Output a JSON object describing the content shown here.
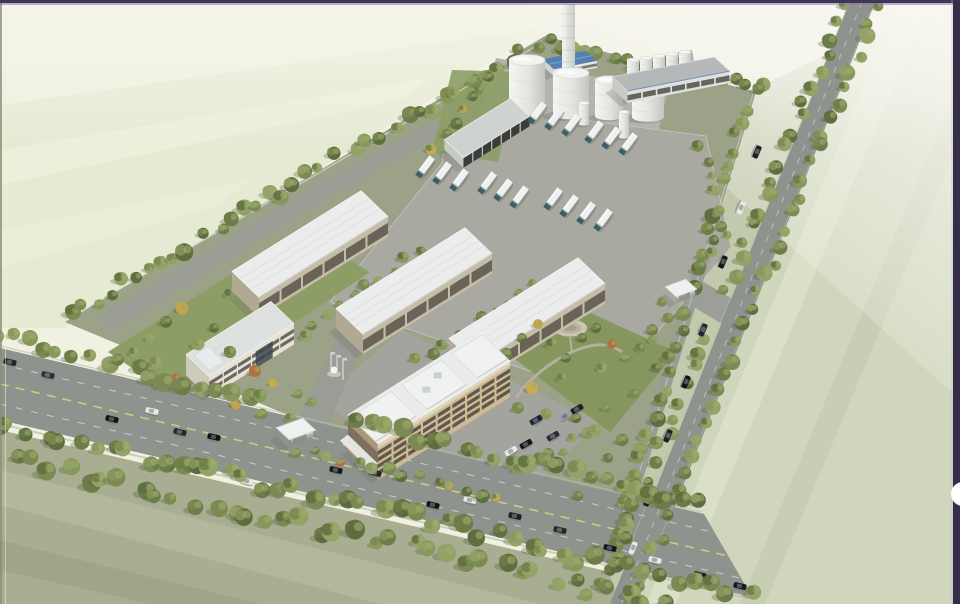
{
  "meta": {
    "subject": "aerial-rendering-industrial-campus",
    "canvas": {
      "w": 960,
      "h": 604
    }
  },
  "ui": {
    "next_button_color": "#ffffff"
  },
  "palette": {
    "base": "#f0f1e1",
    "sky_top": "#f5f4ea",
    "haze": "#f8f7f1",
    "field_nw": "#e6ead3",
    "field_nw_stripe": "#eef1dc",
    "field_sw": "#a9ae92",
    "field_sw_stripe1": "#b5ba9d",
    "field_sw_stripe2": "#9da387",
    "field_e": "#cfd6bc",
    "field_e_stripe1": "#dae0c8",
    "field_e_stripe2": "#c5ccb1",
    "field_band": "#c2c9ad",
    "campus": "#9ba287",
    "pavement": "#a9a9a1",
    "pavement2": "#a3a49d",
    "drive": "#9a9d96",
    "tank_pad": "#b3b4ad",
    "platform": "#b0b3ac",
    "road": "#8f938e",
    "road_edge": "#bcbfb3",
    "fence": "#d9dcd0",
    "lane_yellow": "#cfcf7d",
    "lane_white": "#dadcd5",
    "grass": "#8c9d66",
    "grass2": "#85965e",
    "path": "#b7b3a6",
    "plaza_outer": "#cdc6b2",
    "plaza_mid": "#b9b19b",
    "plaza_inner": "#a79e87",
    "tree_greens": [
      "#6d7c49",
      "#7b8a52",
      "#88985c",
      "#93a267",
      "#5f6e3f"
    ],
    "tree_accents": [
      "#c3a34c",
      "#b4703f",
      "#c9ab4d"
    ],
    "tree_shadow": "#4f5c38",
    "tree_highlight": "#9fae6d",
    "roof_white": "#ebedec",
    "roof_line": "#d6d8d9",
    "roof_edge_shade": "#c9cccb",
    "wall_tan": "#c6bda9",
    "wall_tan_dark": "#b2a995",
    "window_dark": "#514c44",
    "office_wall": "#cdbb97",
    "office_wall_dark": "#ab9878",
    "office_window": "#46403a",
    "office_parapet": "#e0d4b6",
    "small_office_wall": "#e6e3d6",
    "small_office_wall_dark": "#cfcaba",
    "small_office_roof": "#dde1e0",
    "glass_dark": "#3f4750",
    "long_roof": "#b4b8b8",
    "long_wall": "#e0e1db",
    "canopy_roof": "#ced2d1",
    "canopy_dark": "#3a3d38",
    "blue_roof": "#5580b2",
    "blue_ridge": "#7da0cc",
    "gate_roof": "#eff1f0",
    "tank_light": "#f5f6f3",
    "tank_mid": "#e2e4df",
    "tank_dark": "#c2c5bf",
    "tank_top": "#f2f3f0",
    "tank_seam": "#d2d4cf",
    "chimney_light": "#f2f3f0",
    "chimney_dark": "#c9ccc6",
    "chimney_band": "#b7bab4",
    "truck_body": "#eef1f0",
    "truck_cab": "#3d5f63",
    "truck_glass": "#9fb8ba",
    "shadow": "#6f746c",
    "frame_top": "#41345a",
    "frame_top2": "#8379a0",
    "frame_right": "#352d4a",
    "frame_left": "#8a8f7c",
    "frame_left_accent": "#eef0c4",
    "flag_pole": "#e8e8e4",
    "flag": "#cfd2d6",
    "fountain": "#f4f5f2",
    "fountain_base": "#c9c4b4"
  },
  "scene": {
    "tree_bands": [
      {
        "id": "nw-boundary",
        "x1": 70,
        "y1": 316,
        "x2": 538,
        "y2": 42,
        "n": 36,
        "r1": 5,
        "r2": 9,
        "j": 7,
        "palette": "green"
      },
      {
        "id": "north-tanks",
        "x1": 546,
        "y1": 40,
        "x2": 758,
        "y2": 88,
        "n": 17,
        "r1": 5,
        "r2": 8,
        "j": 6,
        "palette": "green"
      },
      {
        "id": "tanks-garden",
        "x1": 436,
        "y1": 148,
        "x2": 486,
        "y2": 78,
        "n": 7,
        "r1": 4,
        "r2": 6,
        "j": 5,
        "palette": "mixed"
      },
      {
        "id": "east-inner",
        "x1": 753,
        "y1": 94,
        "x2": 614,
        "y2": 548,
        "n": 32,
        "r1": 5,
        "r2": 8,
        "j": 6,
        "palette": "green",
        "gaps": [
          [
            0.42,
            0.48
          ]
        ]
      },
      {
        "id": "east-road-west",
        "x1": 845,
        "y1": 8,
        "x2": 602,
        "y2": 588,
        "n": 38,
        "r1": 5,
        "r2": 8,
        "j": 5,
        "palette": "green",
        "gaps": [
          [
            0.49,
            0.545
          ]
        ]
      },
      {
        "id": "east-road-east",
        "x1": 877,
        "y1": 4,
        "x2": 634,
        "y2": 600,
        "n": 38,
        "r1": 5,
        "r2": 8,
        "j": 5,
        "palette": "green"
      },
      {
        "id": "ne-parking-strip",
        "x1": 700,
        "y1": 142,
        "x2": 728,
        "y2": 238,
        "n": 7,
        "r1": 4,
        "r2": 6,
        "j": 5,
        "palette": "green"
      },
      {
        "id": "nw-wh1",
        "x1": 228,
        "y1": 296,
        "x2": 344,
        "y2": 212,
        "n": 10,
        "r1": 4,
        "r2": 6,
        "j": 4,
        "palette": "mixed"
      },
      {
        "id": "wh1-2",
        "x1": 302,
        "y1": 332,
        "x2": 420,
        "y2": 252,
        "n": 10,
        "r1": 4,
        "r2": 6,
        "j": 4,
        "palette": "green"
      },
      {
        "id": "wh2-3",
        "x1": 418,
        "y1": 362,
        "x2": 534,
        "y2": 286,
        "n": 10,
        "r1": 4,
        "r2": 6,
        "j": 4,
        "palette": "green"
      },
      {
        "id": "drive-south",
        "x1": 296,
        "y1": 450,
        "x2": 500,
        "y2": 498,
        "n": 14,
        "r1": 4,
        "r2": 7,
        "j": 5,
        "palette": "mixed"
      },
      {
        "id": "se-office",
        "x1": 516,
        "y1": 470,
        "x2": 600,
        "y2": 432,
        "n": 8,
        "r1": 4,
        "r2": 6,
        "j": 5,
        "palette": "green"
      },
      {
        "id": "sw-road-north",
        "x1": -5,
        "y1": 336,
        "x2": 700,
        "y2": 503,
        "n": 46,
        "r1": 6,
        "r2": 10,
        "j": 6,
        "palette": "green",
        "gaps": [
          [
            0.4,
            0.5
          ]
        ]
      },
      {
        "id": "sw-road-south1",
        "x1": -5,
        "y1": 424,
        "x2": 748,
        "y2": 594,
        "n": 46,
        "r1": 6,
        "r2": 10,
        "j": 7,
        "palette": "green"
      },
      {
        "id": "sw-road-south2",
        "x1": -5,
        "y1": 456,
        "x2": 700,
        "y2": 612,
        "n": 40,
        "r1": 6,
        "r2": 10,
        "j": 8,
        "palette": "green"
      }
    ],
    "trees": {
      "central_garden": [
        [
          506,
          354
        ],
        [
          522,
          338
        ],
        [
          538,
          324,
          "#c3a34c"
        ],
        [
          552,
          344
        ],
        [
          566,
          358
        ],
        [
          582,
          338
        ],
        [
          596,
          328
        ],
        [
          612,
          344,
          "#b4703f"
        ],
        [
          626,
          358
        ],
        [
          640,
          348
        ],
        [
          602,
          368
        ],
        [
          562,
          378
        ],
        [
          532,
          388,
          "#c9ab4d"
        ],
        [
          518,
          408
        ],
        [
          546,
          414
        ],
        [
          576,
          418
        ],
        [
          606,
          408
        ],
        [
          634,
          394
        ],
        [
          656,
          368
        ],
        [
          652,
          340
        ]
      ],
      "west_garden": [
        [
          150,
          338
        ],
        [
          166,
          322
        ],
        [
          182,
          308,
          "#c3a34c"
        ],
        [
          198,
          344
        ],
        [
          214,
          328
        ],
        [
          230,
          352
        ],
        [
          156,
          362
        ],
        [
          176,
          378,
          "#b4703f"
        ],
        [
          206,
          392
        ],
        [
          236,
          404,
          "#c3a34c"
        ],
        [
          262,
          414
        ],
        [
          290,
          418
        ],
        [
          312,
          402
        ],
        [
          134,
          352
        ],
        [
          255,
          371,
          "#b4703f"
        ],
        [
          273,
          383,
          "#c9ab4d"
        ],
        [
          298,
          394
        ]
      ],
      "east_gate_area": [
        [
          662,
          302
        ],
        [
          668,
          318
        ],
        [
          652,
          330
        ],
        [
          700,
          266
        ],
        [
          712,
          252
        ]
      ],
      "bottom_right": [
        [
          592,
          478
        ],
        [
          608,
          458
        ],
        [
          622,
          440
        ],
        [
          578,
          496
        ]
      ]
    },
    "buildings": [
      {
        "id": "boiler-house",
        "type": "blue",
        "cx": 570,
        "cy": 60,
        "a": -11,
        "L": 44,
        "wx": 11,
        "wy": 10,
        "h": 7
      },
      {
        "id": "service-building",
        "type": "long",
        "cx": 671,
        "cy": 74,
        "a": -11,
        "L": 104,
        "wx": 15,
        "wy": 14,
        "h": 12
      },
      {
        "id": "garage-canopy",
        "type": "canopy",
        "cx": 487,
        "cy": 128,
        "a": -32,
        "L": 78,
        "wx": 19,
        "wy": 18,
        "h": 10
      },
      {
        "id": "warehouse-1",
        "type": "warehouse",
        "cx": 310,
        "cy": 244,
        "a": -32,
        "L": 152,
        "wx": 27,
        "wy": 26,
        "h": 20
      },
      {
        "id": "warehouse-2",
        "type": "warehouse",
        "cx": 414,
        "cy": 281,
        "a": -32,
        "L": 152,
        "wx": 27,
        "wy": 26,
        "h": 20
      },
      {
        "id": "warehouse-3",
        "type": "warehouse",
        "cx": 527,
        "cy": 311,
        "a": -32,
        "L": 152,
        "wx": 27,
        "wy": 26,
        "h": 20
      },
      {
        "id": "admin-office",
        "type": "small-office",
        "cx": 240,
        "cy": 339,
        "a": -32,
        "L": 100,
        "wx": 23,
        "wy": 22,
        "h": 21
      },
      {
        "id": "main-office",
        "type": "office",
        "cx": 429,
        "cy": 388,
        "a": -32,
        "L": 156,
        "wx": 30,
        "wy": 29,
        "h": 36
      },
      {
        "id": "main-gatehouse",
        "type": "gate",
        "cx": 296,
        "cy": 429,
        "a": -20,
        "L": 28,
        "wx": 13,
        "wy": 12,
        "h": 8
      },
      {
        "id": "east-gatehouse",
        "type": "gate",
        "cx": 681,
        "cy": 288,
        "a": -20,
        "L": 22,
        "wx": 11,
        "wy": 10,
        "h": 7
      }
    ],
    "tanks": {
      "large": [
        [
          527,
          18,
          60,
          110
        ],
        [
          571,
          18,
          73,
          114
        ],
        [
          609,
          14,
          80,
          116
        ],
        [
          648,
          16,
          87,
          117
        ]
      ],
      "small": [
        [
          584,
          5,
          103,
          124
        ],
        [
          624,
          5,
          112,
          137
        ]
      ],
      "platform_row": [
        [
          633,
          6,
          60,
          76
        ],
        [
          646,
          6,
          58,
          74
        ],
        [
          659,
          6,
          56,
          72
        ],
        [
          672,
          6,
          54,
          70
        ],
        [
          685,
          6,
          52,
          68
        ]
      ]
    },
    "chimney": {
      "x": 562,
      "w": 13,
      "top": 4,
      "bot": 80
    },
    "trucks": [
      [
        537,
        113
      ],
      [
        554,
        119
      ],
      [
        571,
        125
      ],
      [
        594,
        132
      ],
      [
        611,
        138
      ],
      [
        628,
        144
      ],
      [
        425,
        167
      ],
      [
        442,
        173
      ],
      [
        459,
        180
      ],
      [
        487,
        183
      ],
      [
        503,
        190
      ],
      [
        519,
        197
      ],
      [
        553,
        199
      ],
      [
        569,
        206
      ],
      [
        586,
        213
      ],
      [
        603,
        220
      ]
    ],
    "cars": {
      "road_sw": {
        "angle": 13,
        "items": [
          [
            10,
            362,
            "#20242b"
          ],
          [
            48,
            375,
            "#2b3039"
          ],
          [
            112,
            419,
            "#101318"
          ],
          [
            152,
            411,
            "#e9eae8"
          ],
          [
            180,
            432,
            "#23272e"
          ],
          [
            214,
            437,
            "#0e1116"
          ],
          [
            247,
            481,
            "#e6e7e5"
          ],
          [
            266,
            489,
            "#191d24"
          ],
          [
            336,
            470,
            "#15181f"
          ],
          [
            375,
            473,
            "#22262e"
          ],
          [
            433,
            505,
            "#101318"
          ],
          [
            470,
            500,
            "#e8e9e7"
          ],
          [
            515,
            516,
            "#1b1f26"
          ],
          [
            560,
            530,
            "#23272f"
          ],
          [
            610,
            548,
            "#12151b"
          ],
          [
            655,
            560,
            "#e7e8e6"
          ],
          [
            700,
            575,
            "#1d2128"
          ],
          [
            740,
            586,
            "#14171d"
          ]
        ]
      },
      "road_e": {
        "angle": 113,
        "items": [
          [
            757,
            152,
            "#1a1e25"
          ],
          [
            741,
            208,
            "#e8e9e7"
          ],
          [
            723,
            262,
            "#14171d"
          ],
          [
            703,
            330,
            "#22262e"
          ],
          [
            686,
            382,
            "#101318"
          ],
          [
            668,
            436,
            "#1d2127"
          ],
          [
            648,
            500,
            "#171b21"
          ],
          [
            633,
            548,
            "#e7e8e5"
          ]
        ]
      },
      "office_parking": {
        "angle": -30,
        "items": [
          [
            536,
            420,
            "#1d2430"
          ],
          [
            526,
            444,
            "#10141a"
          ],
          [
            511,
            451,
            "#e9eae8"
          ],
          [
            553,
            436,
            "#262b34"
          ],
          [
            565,
            416,
            "#9aa0a6"
          ],
          [
            545,
            458,
            "#0d1015"
          ],
          [
            577,
            409,
            "#1a1f27"
          ]
        ]
      }
    },
    "flags": [
      [
        331,
        374
      ],
      [
        337,
        377
      ],
      [
        343,
        380
      ]
    ],
    "fountain": {
      "x": 334,
      "y": 371
    }
  }
}
